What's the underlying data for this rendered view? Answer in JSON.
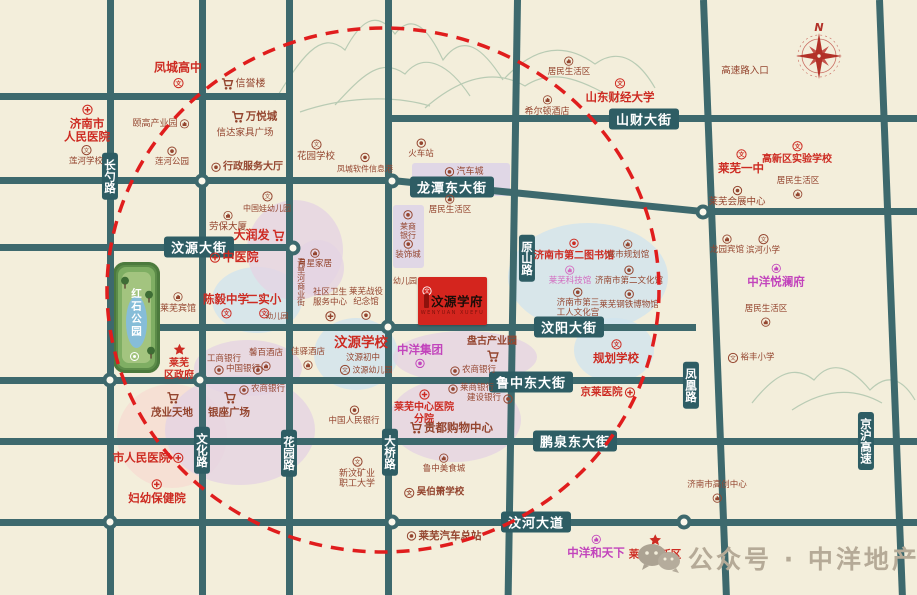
{
  "watermark": {
    "text": "公众号 · 中洋地产"
  },
  "compass": {
    "north": "N"
  },
  "property": {
    "name": "汶源学府",
    "pinyin": "WENYUAN XUEFU"
  },
  "park": {
    "name": "红石公园"
  },
  "colors": {
    "background": "#f3eedb",
    "road": "#3d696d",
    "road_label_box": "#2e5d64",
    "poi_red": "#cd2b22",
    "poi_maroon": "#94452f",
    "brand_magenta": "#c244bc",
    "estate_box": "#d4251e",
    "ring_dash": "#e01d1d",
    "blob_blue": "#cfe4ee",
    "blob_pink": "#e4d4e3",
    "blob_peach": "#f6ddd2"
  },
  "road_labels": [
    {
      "t": "汶源大街",
      "x": 199,
      "y": 247
    },
    {
      "t": "龙潭东大街",
      "x": 452,
      "y": 187
    },
    {
      "t": "山财大街",
      "x": 644,
      "y": 119
    },
    {
      "t": "汶阳大街",
      "x": 569,
      "y": 327
    },
    {
      "t": "鲁中东大街",
      "x": 531,
      "y": 382
    },
    {
      "t": "鹏泉东大街",
      "x": 575,
      "y": 441
    },
    {
      "t": "汶河大道",
      "x": 536,
      "y": 522
    },
    {
      "t": "长勺路",
      "x": 110,
      "y": 176,
      "v": 1
    },
    {
      "t": "原山路",
      "x": 527,
      "y": 258,
      "v": 1
    },
    {
      "t": "文化路",
      "x": 202,
      "y": 450,
      "v": 1
    },
    {
      "t": "花园路",
      "x": 289,
      "y": 453,
      "v": 1
    },
    {
      "t": "大桥路",
      "x": 390,
      "y": 452,
      "v": 1
    },
    {
      "t": "凤凰路",
      "x": 691,
      "y": 385,
      "v": 1
    },
    {
      "t": "京沪高速",
      "x": 866,
      "y": 441,
      "v": 1
    }
  ],
  "pois": [
    {
      "t": "凤城高中",
      "x": 178,
      "y": 75,
      "c": "red",
      "i": "school",
      "ip": "bottom",
      "fs": 12,
      "b": 1
    },
    {
      "t": "信誉楼",
      "x": 243,
      "y": 84,
      "c": "maroon",
      "i": "cart",
      "ip": "left",
      "fs": 10
    },
    {
      "t": "济南市\n人民医院",
      "x": 87,
      "y": 124,
      "c": "red",
      "i": "hospital",
      "ip": "top",
      "fs": 11.5,
      "b": 1
    },
    {
      "t": "颐高产业园",
      "x": 161,
      "y": 124,
      "c": "maroon",
      "i": "building",
      "ip": "right",
      "fs": 9
    },
    {
      "t": "莲河学校",
      "x": 86,
      "y": 156,
      "c": "maroon",
      "i": "school",
      "ip": "top",
      "fs": 8.5
    },
    {
      "t": "莲河公园",
      "x": 172,
      "y": 157,
      "c": "maroon",
      "i": "poi",
      "ip": "top",
      "fs": 8.5
    },
    {
      "t": "万悦城",
      "x": 254,
      "y": 117,
      "c": "maroon",
      "i": "cart",
      "ip": "left",
      "fs": 10.5,
      "b": 1
    },
    {
      "t": "信达家具广场",
      "x": 245,
      "y": 134,
      "c": "maroon",
      "fs": 9.5
    },
    {
      "t": "行政服务大厅",
      "x": 247,
      "y": 167,
      "c": "maroon",
      "i": "poi",
      "ip": "left",
      "fs": 10,
      "b": 1
    },
    {
      "t": "花园学校",
      "x": 316,
      "y": 151,
      "c": "maroon",
      "i": "school",
      "ip": "top",
      "fs": 9.5
    },
    {
      "t": "凤城软件信息港",
      "x": 365,
      "y": 163,
      "c": "maroon",
      "i": "poi",
      "ip": "top",
      "fs": 8
    },
    {
      "t": "火车站",
      "x": 421,
      "y": 149,
      "c": "maroon",
      "i": "poi",
      "ip": "top",
      "fs": 8.5
    },
    {
      "t": "汽车城",
      "x": 464,
      "y": 172,
      "c": "maroon",
      "i": "poi",
      "ip": "left",
      "fs": 9
    },
    {
      "t": "居民生活区",
      "x": 569,
      "y": 67,
      "c": "maroon",
      "i": "building",
      "ip": "top",
      "fs": 8.5
    },
    {
      "t": "希尔顿酒店",
      "x": 547,
      "y": 106,
      "c": "maroon",
      "i": "building",
      "ip": "top",
      "fs": 9
    },
    {
      "t": "山东财经大学",
      "x": 620,
      "y": 91,
      "c": "red",
      "i": "school",
      "ip": "top",
      "fs": 11.5,
      "b": 1
    },
    {
      "t": "高速路入口",
      "x": 745,
      "y": 72,
      "c": "maroon",
      "fs": 9.5
    },
    {
      "t": "莱芜一中",
      "x": 741,
      "y": 162,
      "c": "red",
      "i": "school",
      "ip": "top",
      "fs": 11.5,
      "b": 1
    },
    {
      "t": "高新区实验学校",
      "x": 797,
      "y": 153,
      "c": "red",
      "i": "school",
      "ip": "top",
      "fs": 10,
      "b": 1
    },
    {
      "t": "莱芜会展中心",
      "x": 737,
      "y": 197,
      "c": "maroon",
      "i": "poi",
      "ip": "top",
      "fs": 9.5
    },
    {
      "t": "居民生活区",
      "x": 798,
      "y": 188,
      "c": "maroon",
      "i": "building",
      "ip": "bottom",
      "fs": 8.5
    },
    {
      "t": "龙园宾馆",
      "x": 727,
      "y": 245,
      "c": "maroon",
      "i": "building",
      "ip": "top",
      "fs": 8.5
    },
    {
      "t": "滨河小学",
      "x": 763,
      "y": 245,
      "c": "maroon",
      "i": "school",
      "ip": "top",
      "fs": 8.5
    },
    {
      "t": "中洋悦澜府",
      "x": 776,
      "y": 276,
      "c": "magenta",
      "i": "building",
      "ip": "top",
      "fs": 11.5,
      "b": 1
    },
    {
      "t": "居民生活区",
      "x": 766,
      "y": 316,
      "c": "maroon",
      "i": "building",
      "ip": "bottom",
      "fs": 8.5
    },
    {
      "t": "裕丰小学",
      "x": 751,
      "y": 358,
      "c": "maroon",
      "i": "school",
      "ip": "left",
      "fs": 8.5
    },
    {
      "t": "中国娃幼儿园",
      "x": 267,
      "y": 202,
      "c": "maroon",
      "i": "school",
      "ip": "top",
      "fs": 8
    },
    {
      "t": "劳保大厦",
      "x": 228,
      "y": 222,
      "c": "maroon",
      "i": "building",
      "ip": "top",
      "fs": 9.5
    },
    {
      "t": "大润发",
      "x": 259,
      "y": 236,
      "c": "red",
      "i": "cart",
      "ip": "right",
      "fs": 12,
      "b": 1
    },
    {
      "t": "中医院",
      "x": 234,
      "y": 258,
      "c": "red",
      "i": "hospital",
      "ip": "left",
      "fs": 12,
      "b": 1
    },
    {
      "t": "莱商\n银行",
      "x": 408,
      "y": 225,
      "c": "maroon",
      "i": "bank",
      "ip": "top",
      "fs": 8
    },
    {
      "t": "装饰城",
      "x": 408,
      "y": 250,
      "c": "maroon",
      "i": "bank",
      "ip": "top",
      "fs": 8.5
    },
    {
      "t": "居民生活区",
      "x": 450,
      "y": 205,
      "c": "maroon",
      "i": "building",
      "ip": "top",
      "fs": 8.5
    },
    {
      "t": "月星家居",
      "x": 315,
      "y": 259,
      "c": "maroon",
      "i": "building",
      "ip": "top",
      "fs": 8.5
    },
    {
      "t": "青草河商业街",
      "x": 301,
      "y": 282,
      "c": "maroon",
      "fs": 8,
      "vert": 1
    },
    {
      "t": "陈毅中学",
      "x": 226,
      "y": 306,
      "c": "red",
      "i": "school",
      "ip": "bottom",
      "fs": 11.5,
      "b": 1
    },
    {
      "t": "二实小",
      "x": 264,
      "y": 306,
      "c": "red",
      "i": "school",
      "ip": "bottom",
      "fs": 11.5,
      "b": 1
    },
    {
      "t": "幼儿园",
      "x": 277,
      "y": 317,
      "c": "maroon",
      "fs": 7.5
    },
    {
      "t": "莱芜宾馆",
      "x": 178,
      "y": 303,
      "c": "maroon",
      "i": "building",
      "ip": "top",
      "fs": 9
    },
    {
      "t": "社区卫生\n服务中心",
      "x": 330,
      "y": 305,
      "c": "maroon",
      "i": "hospital",
      "ip": "bottom",
      "fs": 8.5
    },
    {
      "t": "莱芜战役\n纪念馆",
      "x": 366,
      "y": 304,
      "c": "maroon",
      "i": "poi",
      "ip": "bottom",
      "fs": 8.5
    },
    {
      "t": "幼儿园",
      "x": 405,
      "y": 281,
      "c": "maroon",
      "fs": 8
    },
    {
      "t": "莱芜\n区政府",
      "x": 179,
      "y": 362,
      "c": "red",
      "i": "star",
      "ip": "top",
      "fs": 10,
      "b": 1
    },
    {
      "t": "工商银行",
      "x": 224,
      "y": 360,
      "c": "maroon",
      "fs": 8.5
    },
    {
      "t": "中国银行",
      "x": 237,
      "y": 370,
      "c": "maroon",
      "i": "bank",
      "ip": "left",
      "fs": 8.5
    },
    {
      "t": "",
      "x": 258,
      "y": 370,
      "c": "maroon",
      "i": "bank",
      "ip": "left",
      "fs": 8
    },
    {
      "t": "馨百酒店",
      "x": 266,
      "y": 360,
      "c": "maroon",
      "i": "building",
      "ip": "bottom",
      "fs": 8.5
    },
    {
      "t": "佳驿酒店",
      "x": 308,
      "y": 359,
      "c": "maroon",
      "i": "building",
      "ip": "bottom",
      "fs": 8.5
    },
    {
      "t": "汶源学校",
      "x": 361,
      "y": 344,
      "c": "red",
      "fs": 13.5,
      "b": 1
    },
    {
      "t": "汶源初中",
      "x": 363,
      "y": 359,
      "c": "maroon",
      "fs": 8.5
    },
    {
      "t": "汶源幼儿园",
      "x": 366,
      "y": 370,
      "c": "maroon",
      "i": "school",
      "ip": "left",
      "fs": 8
    },
    {
      "t": "中洋集团",
      "x": 420,
      "y": 356,
      "c": "magenta",
      "i": "bank",
      "ip": "bottom",
      "fs": 11.5,
      "b": 1
    },
    {
      "t": "盘古产业园",
      "x": 492,
      "y": 349,
      "c": "maroon",
      "i": "cart",
      "ip": "bottom",
      "fs": 10,
      "b": 1
    },
    {
      "t": "农商银行",
      "x": 473,
      "y": 371,
      "c": "maroon",
      "i": "bank",
      "ip": "left",
      "fs": 8.5
    },
    {
      "t": "莱商银行",
      "x": 471,
      "y": 389,
      "c": "maroon",
      "i": "bank",
      "ip": "left",
      "fs": 8.5
    },
    {
      "t": "建设银行",
      "x": 490,
      "y": 399,
      "c": "maroon",
      "i": "bank",
      "ip": "right",
      "fs": 8.5
    },
    {
      "t": "济南市第二图书馆",
      "x": 574,
      "y": 250,
      "c": "red",
      "i": "poi",
      "ip": "top",
      "fs": 10,
      "b": 1
    },
    {
      "t": "城市规划馆",
      "x": 628,
      "y": 250,
      "c": "maroon",
      "i": "building",
      "ip": "top",
      "fs": 8.5
    },
    {
      "t": "莱芜科技馆",
      "x": 570,
      "y": 276,
      "c": "pink",
      "i": "building",
      "ip": "top",
      "fs": 8.5
    },
    {
      "t": "济南市第二文化馆",
      "x": 629,
      "y": 276,
      "c": "maroon",
      "i": "poi",
      "ip": "top",
      "fs": 8.5
    },
    {
      "t": "济南市第三\n工人文化宫",
      "x": 578,
      "y": 303,
      "c": "maroon",
      "i": "poi",
      "ip": "top",
      "fs": 8.5
    },
    {
      "t": "莱芜钢铁博物馆",
      "x": 629,
      "y": 300,
      "c": "maroon",
      "i": "poi",
      "ip": "top",
      "fs": 8.5
    },
    {
      "t": "规划学校",
      "x": 616,
      "y": 352,
      "c": "red",
      "i": "school",
      "ip": "top",
      "fs": 11.5,
      "b": 1
    },
    {
      "t": "京莱医院",
      "x": 608,
      "y": 392,
      "c": "red",
      "i": "hospital",
      "ip": "right",
      "fs": 10.5,
      "b": 1
    },
    {
      "t": "茂业天地",
      "x": 172,
      "y": 405,
      "c": "maroon",
      "i": "cart",
      "ip": "top",
      "fs": 10.5,
      "b": 1
    },
    {
      "t": "银座广场",
      "x": 229,
      "y": 405,
      "c": "maroon",
      "i": "cart",
      "ip": "top",
      "fs": 10.5,
      "b": 1
    },
    {
      "t": "农商银行",
      "x": 262,
      "y": 390,
      "c": "maroon",
      "i": "bank",
      "ip": "left",
      "fs": 8.5
    },
    {
      "t": "市人民医院",
      "x": 148,
      "y": 458,
      "c": "red",
      "i": "hospital",
      "ip": "right",
      "fs": 11.5,
      "b": 1
    },
    {
      "t": "妇幼保健院",
      "x": 157,
      "y": 492,
      "c": "red",
      "i": "hospital",
      "ip": "top",
      "fs": 11.5,
      "b": 1
    },
    {
      "t": "中国人民银行",
      "x": 354,
      "y": 416,
      "c": "maroon",
      "i": "bank",
      "ip": "top",
      "fs": 8.5
    },
    {
      "t": "莱芜中心医院\n分院",
      "x": 424,
      "y": 407,
      "c": "red",
      "i": "hospital",
      "ip": "top",
      "fs": 10,
      "b": 1
    },
    {
      "t": "贵都购物中心",
      "x": 451,
      "y": 428,
      "c": "maroon",
      "i": "cart",
      "ip": "left",
      "fs": 11.5,
      "b": 1
    },
    {
      "t": "鲁中美食城",
      "x": 444,
      "y": 464,
      "c": "maroon",
      "i": "building",
      "ip": "top",
      "fs": 8.5
    },
    {
      "t": "新汶矿业\n职工大学",
      "x": 357,
      "y": 473,
      "c": "maroon",
      "i": "school",
      "ip": "top",
      "fs": 9
    },
    {
      "t": "吴伯箫学校",
      "x": 434,
      "y": 493,
      "c": "maroon",
      "i": "school",
      "ip": "left",
      "fs": 9.5,
      "b": 1
    },
    {
      "t": "莱芜汽车总站",
      "x": 444,
      "y": 536,
      "c": "maroon",
      "i": "poi",
      "ip": "left",
      "fs": 10.5,
      "b": 1
    },
    {
      "t": "济南市高创中心",
      "x": 717,
      "y": 492,
      "c": "maroon",
      "i": "building",
      "ip": "bottom",
      "fs": 8.5
    },
    {
      "t": "中洋和天下",
      "x": 596,
      "y": 547,
      "c": "magenta",
      "i": "building",
      "ip": "top",
      "fs": 11.5,
      "b": 1
    },
    {
      "t": "莱芜高新区",
      "x": 655,
      "y": 547,
      "c": "red",
      "i": "star",
      "ip": "top",
      "fs": 10.5,
      "b": 1
    }
  ]
}
